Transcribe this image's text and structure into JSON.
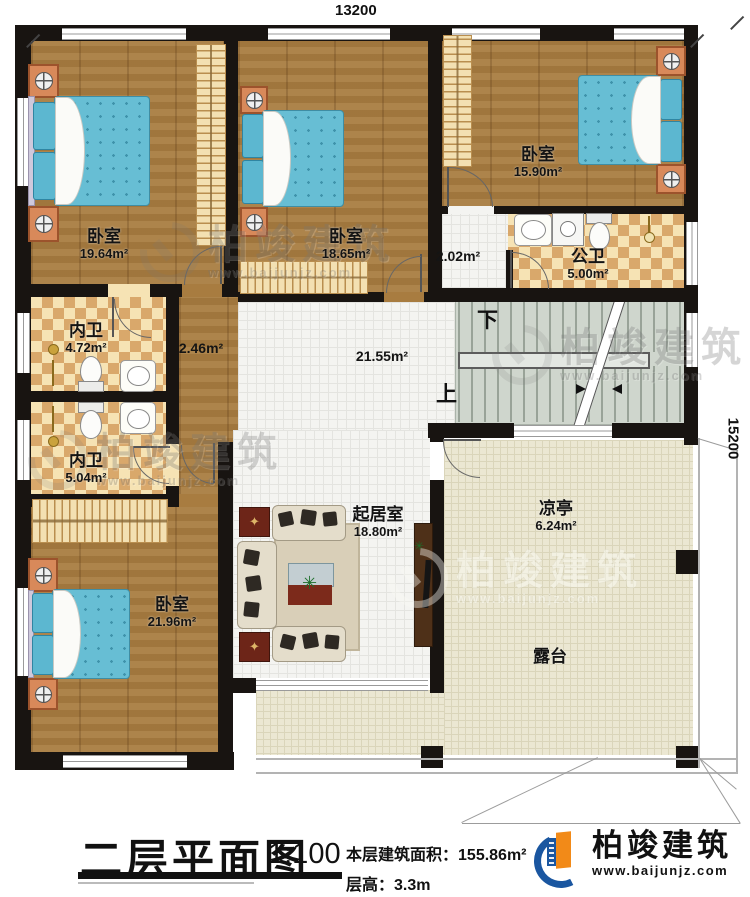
{
  "meta": {
    "title": "二层平面图",
    "scale": "1:100",
    "area_label": "本层建筑面积：",
    "area_value": "155.86m²",
    "floor_height_label": "层高：",
    "floor_height_value": "3.3m"
  },
  "brand": {
    "name": "柏竣建筑",
    "website": "www.baijunjz.com",
    "blue": "#1a56a0",
    "orange": "#f28a18"
  },
  "watermark": {
    "name": "柏竣建筑",
    "website": "www.baijunjz.com"
  },
  "dimensions": {
    "top": "13200",
    "right": "15200"
  },
  "stairs": {
    "down": "下",
    "up": "上"
  },
  "rooms": [
    {
      "name": "卧室",
      "area": "19.64m²"
    },
    {
      "name": "卧室",
      "area": "18.65m²"
    },
    {
      "name": "卧室",
      "area": "15.90m²"
    },
    {
      "name": "公卫",
      "area": "5.00m²"
    },
    {
      "name": "内卫",
      "area": "4.72m²"
    },
    {
      "name": "内卫",
      "area": "5.04m²"
    },
    {
      "name": "卧室",
      "area": "21.96m²"
    },
    {
      "name": "起居室",
      "area": "18.80m²"
    },
    {
      "name": "凉亭",
      "area": "6.24m²"
    },
    {
      "name": "露台",
      "area": ""
    }
  ],
  "spaces": [
    {
      "area": "2.02m²"
    },
    {
      "area": "2.46m²"
    },
    {
      "area": "21.55m²"
    }
  ],
  "icons": {
    "cabinet_star": "✦",
    "plant": "✳"
  },
  "colors": {
    "wall": "#181411",
    "wood": "#a87c40",
    "tile_light": "#f6e3b4",
    "tile_dark": "#d9a86b",
    "hall": "#f4f4f1",
    "stair": "#cfd6cd",
    "terrace": "#ebe7d2",
    "mattress": "#67bed4"
  }
}
